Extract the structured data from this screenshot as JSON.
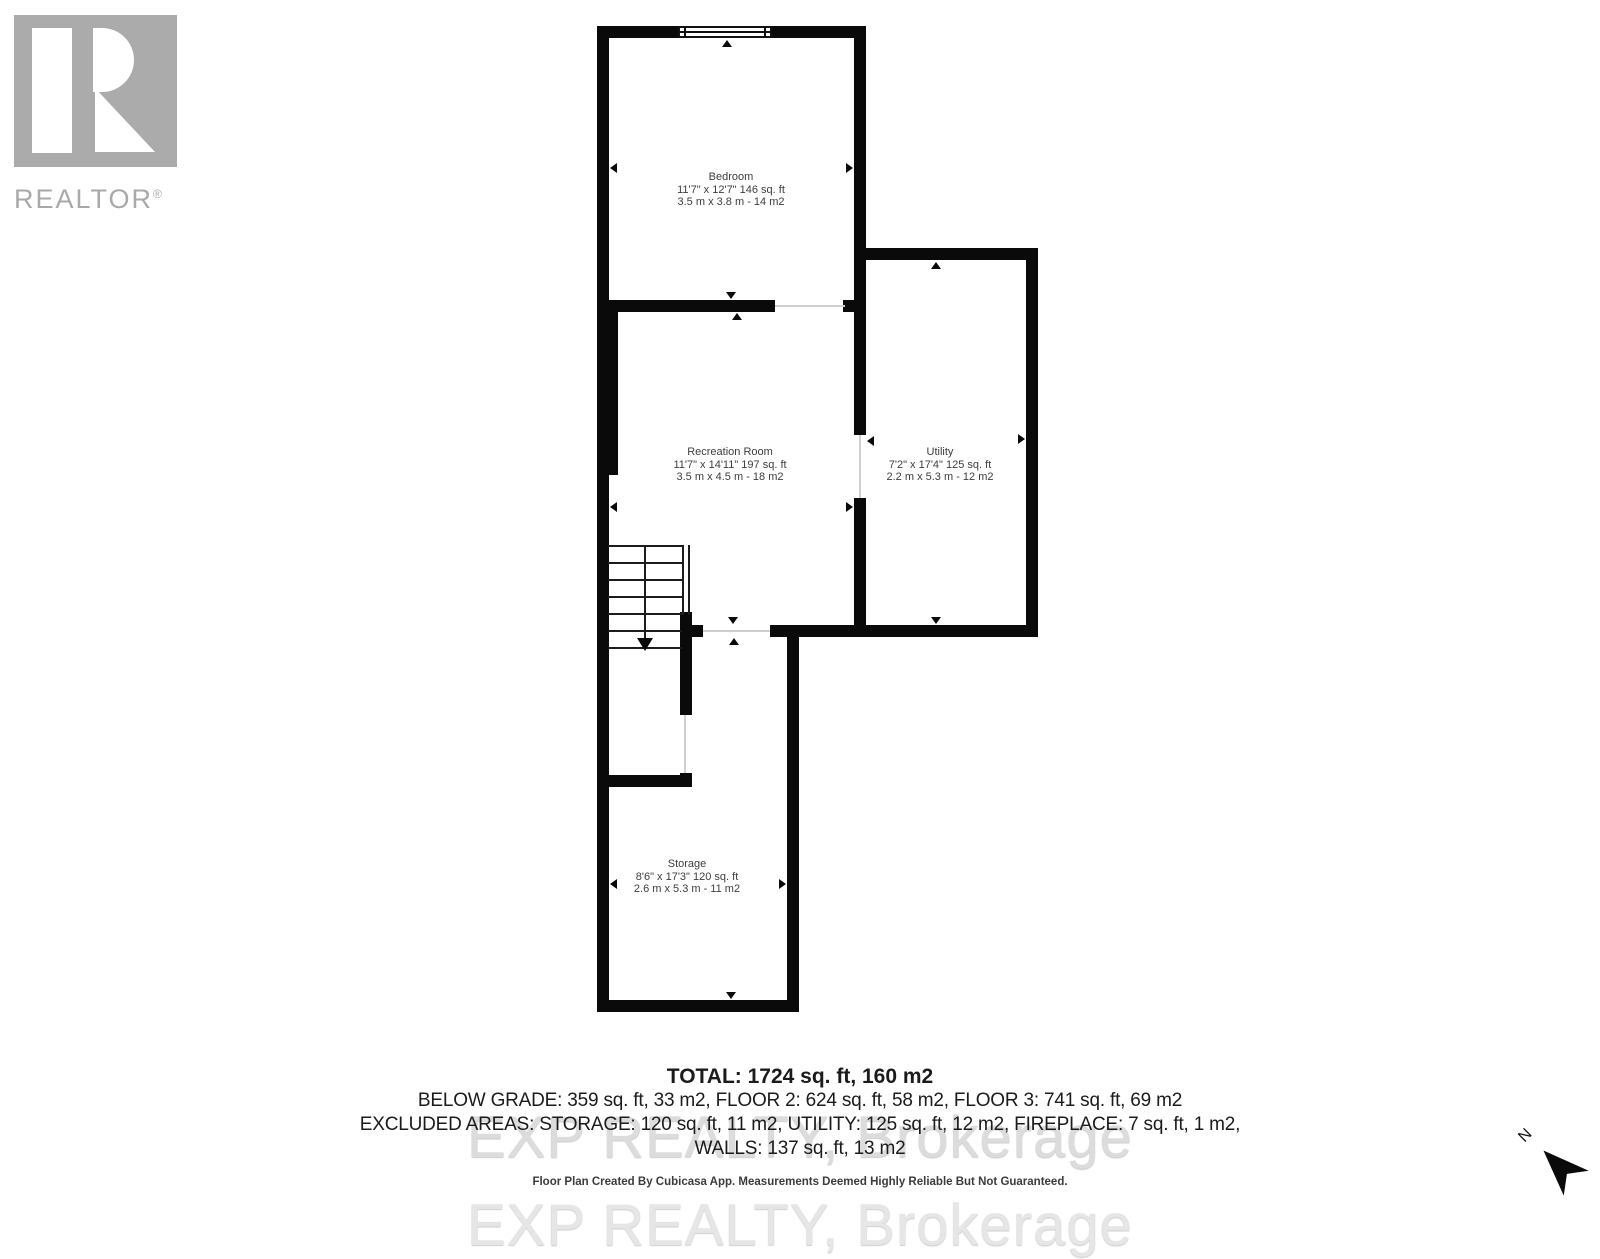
{
  "logo": {
    "brand": "REALTOR",
    "registered": "®"
  },
  "floorplan": {
    "rooms": [
      {
        "name": "Bedroom",
        "dim_ft": "11'7\" x 12'7\" 146 sq. ft",
        "dim_m": "3.5 m x 3.8 m - 14 m2"
      },
      {
        "name": "Recreation Room",
        "dim_ft": "11'7\" x 14'11\" 197 sq. ft",
        "dim_m": "3.5 m x 4.5 m - 18 m2"
      },
      {
        "name": "Utility",
        "dim_ft": "7'2\" x 17'4\" 125 sq. ft",
        "dim_m": "2.2 m x 5.3 m - 12 m2"
      },
      {
        "name": "Storage",
        "dim_ft": "8'6\" x 17'3\" 120 sq. ft",
        "dim_m": "2.6 m x 5.3 m - 11 m2"
      }
    ]
  },
  "summary": {
    "total": "TOTAL: 1724 sq. ft, 160 m2",
    "line2": "BELOW GRADE: 359 sq. ft, 33 m2, FLOOR 2: 624 sq. ft, 58 m2, FLOOR 3: 741 sq. ft, 69 m2",
    "line3": "EXCLUDED AREAS: STORAGE: 120 sq. ft, 11 m2, UTILITY: 125 sq. ft, 12 m2, FIREPLACE: 7 sq. ft, 1 m2,",
    "line4": "WALLS: 137 sq. ft, 13 m2"
  },
  "watermark": "EXP REALTY, Brokerage",
  "disclaimer": "Floor Plan Created By Cubicasa App. Measurements Deemed Highly Reliable But Not Guaranteed.",
  "compass": {
    "label": "N"
  },
  "colors": {
    "wall": "#0a0a0a",
    "logo_gray": "#ababab",
    "label_text": "#3d3d3d",
    "watermark_gray": "#dcdcdc"
  }
}
